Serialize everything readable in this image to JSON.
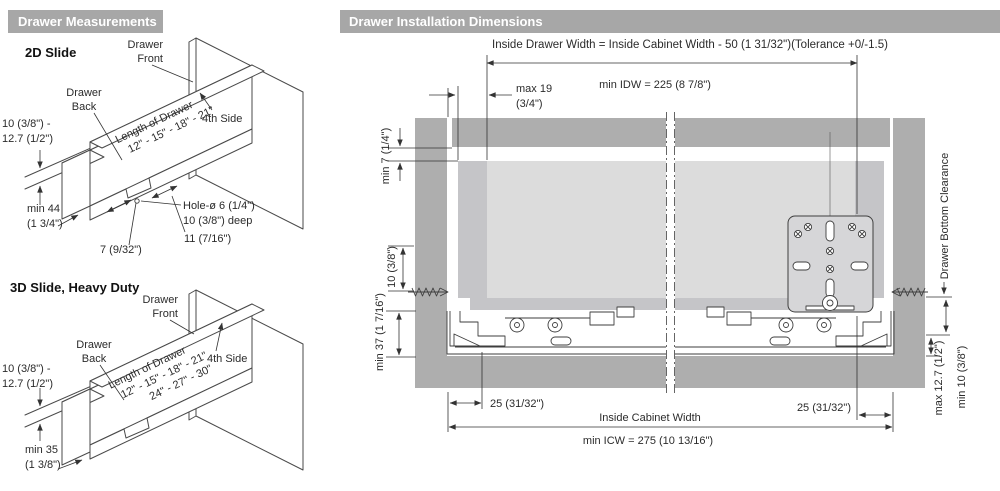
{
  "header": {
    "left": "Drawer Measurements",
    "right": "Drawer Installation Dimensions"
  },
  "slide2d": {
    "title": "2D Slide",
    "front_1": "Drawer",
    "front_2": "Front",
    "back_1": "Drawer",
    "back_2": "Back",
    "thickness_1": "10 (3/8\") -",
    "thickness_2": "12.7 (1/2\")",
    "length_label": "Length of Drawer",
    "lengths": "12\" - 15\" - 18\" - 21\"",
    "fourth_side": "4th Side",
    "back_height_1": "min 44",
    "back_height_2": "(1 3/4\")",
    "hole_offset": "7 (9/32\")",
    "notch_width": "11 (7/16\")",
    "hole_1": "Hole-ø 6 (1/4\")",
    "hole_2": "10 (3/8\") deep"
  },
  "slide3d": {
    "title": "3D Slide, Heavy Duty",
    "front_1": "Drawer",
    "front_2": "Front",
    "back_1": "Drawer",
    "back_2": "Back",
    "thickness_1": "10 (3/8\") -",
    "thickness_2": "12.7 (1/2\")",
    "length_label": "Length of Drawer",
    "lengths_a": "12\" - 15\" - 18\" - 21\"",
    "lengths_b": "24\" - 27\" - 30\"",
    "fourth_side": "4th Side",
    "back_height_1": "min 35",
    "back_height_2": "(1 3/8\")"
  },
  "install": {
    "idw_formula": "Inside Drawer Width = Inside Cabinet Width - 50 (1 31/32\")(Tolerance +0/-1.5)",
    "min_idw": "min IDW = 225 (8 7/8\")",
    "max_side_1": "max 19",
    "max_side_2": "(3/4\")",
    "top_clearance": "min 7 (1/4\")",
    "screw_offset": "10 (3/8\")",
    "bottom_zone": "min 37 (1 7/16\")",
    "drawer_bottom_clearance": "Drawer Bottom Clearance",
    "max_bottom": "max 12.7 (1/2\")",
    "min_bottom": "min 10 (3/8\")",
    "offset_left": "25  (31/32\")",
    "offset_right": "25  (31/32\")",
    "icw_label": "Inside Cabinet Width",
    "min_icw": "min ICW = 275 (10 13/16\")"
  },
  "colors": {
    "header_bg": "#a7a7a7",
    "header_text": "#ffffff",
    "cabinet": "#aeaeae",
    "drawer_wall": "#c5c5c8",
    "drawer_inner": "#dcdcdc",
    "bracket": "#d6d6d8",
    "line": "#4a4a4a"
  }
}
